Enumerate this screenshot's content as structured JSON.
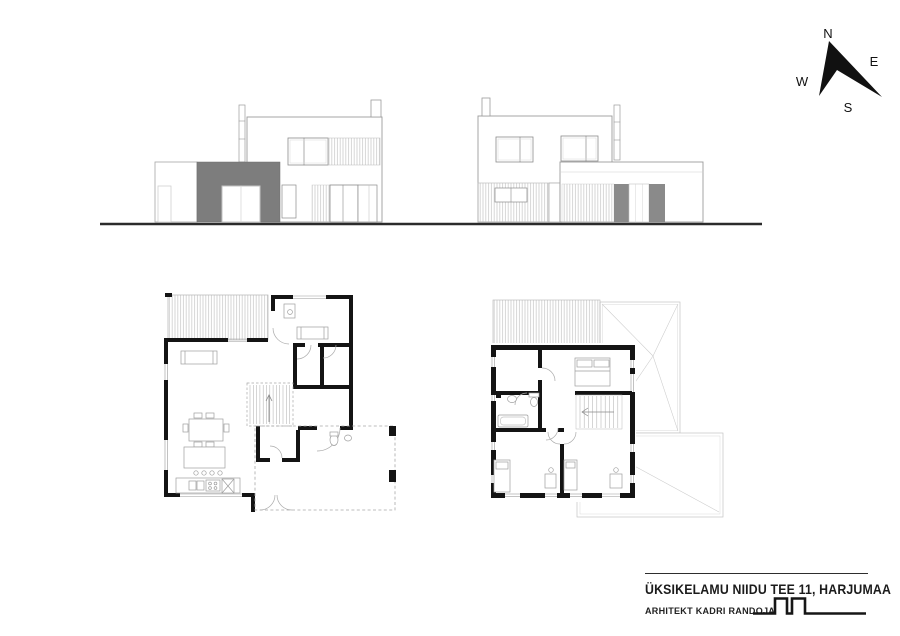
{
  "sheet": {
    "project_title": "ÜKSIKELAMU NIIDU TEE 11, HARJUMAA",
    "architect_line": "ARHITEKT KADRI RANDOJA",
    "background": "#ffffff"
  },
  "compass": {
    "north": "N",
    "east": "E",
    "south": "S",
    "west": "W"
  },
  "colors": {
    "ink": "#1b1b1b",
    "wall_black": "#141414",
    "facade_gray": "#7d7d7d",
    "door_gray": "#8a8a8a",
    "thin_outline": "#9b9b9b",
    "hatch_line": "#c6c6c6",
    "ground_line": "#2b2b2b"
  },
  "graphics": {
    "front_elevation": "front-elevation-drawing",
    "rear_elevation": "rear-elevation-drawing",
    "ground_floor_plan": "ground-floor-plan-drawing",
    "upper_floor_plan": "upper-floor-plan-drawing",
    "north_arrow": "north-arrow-compass",
    "architect_logo": "castellated-line-logo"
  }
}
